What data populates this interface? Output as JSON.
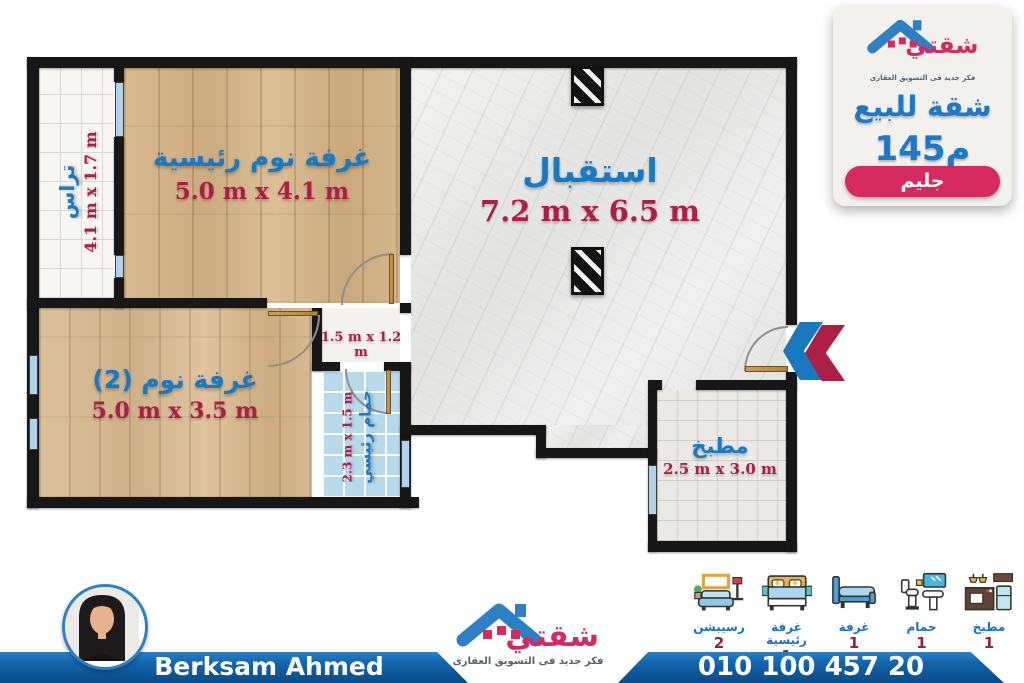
{
  "header_panel": {
    "logo": {
      "brand": "شقتي",
      "tagline": "فكر جديد فى التسويق العقارى"
    },
    "title": "شقة للبيع",
    "area": "145م",
    "location_badge": "جليم"
  },
  "floor_plan": {
    "rooms": {
      "terrace": {
        "name": "تراس",
        "dims": "4.1 m x 1.7 m"
      },
      "master_bedroom": {
        "name": "غرفة نوم رئيسية",
        "dims": "5.0 m x 4.1 m"
      },
      "reception": {
        "name": "استقبال",
        "dims": "7.2 m x 6.5 m"
      },
      "hallway": {
        "dims": "1.5 m x 1.2 m"
      },
      "bedroom_2": {
        "name": "غرفة نوم (2)",
        "dims": "5.0 m x 3.5 m"
      },
      "bathroom": {
        "name": "حمام رئيسي",
        "dims": "2.3 m x 1.5 m"
      },
      "kitchen": {
        "name": "مطبخ",
        "dims": "2.5 m x 3.0 m"
      }
    }
  },
  "legend": {
    "items": [
      {
        "icon": "living-room-icon",
        "label": "رسيبشن",
        "count": "2"
      },
      {
        "icon": "master-bedroom-icon",
        "label": "غرفة رئيسية",
        "count": "1"
      },
      {
        "icon": "bedroom-icon",
        "label": "غرفة",
        "count": "1"
      },
      {
        "icon": "bathroom-icon",
        "label": "حمام",
        "count": "1"
      },
      {
        "icon": "kitchen-icon",
        "label": "مطبخ",
        "count": "1"
      }
    ]
  },
  "footer": {
    "agent_name": "Berksam Ahmed",
    "phone": "010 100 457 20",
    "logo": {
      "brand": "شقتي",
      "tagline": "فكر جديد فى التسويق العقارى"
    }
  },
  "colors": {
    "brand_blue": "#2e80c4",
    "brand_pink": "#d6295e",
    "room_label_blue": "#1879c5",
    "dimension_crimson": "#ae1d46",
    "bar_blue": "#0b4a86",
    "wall_black": "#171717"
  }
}
